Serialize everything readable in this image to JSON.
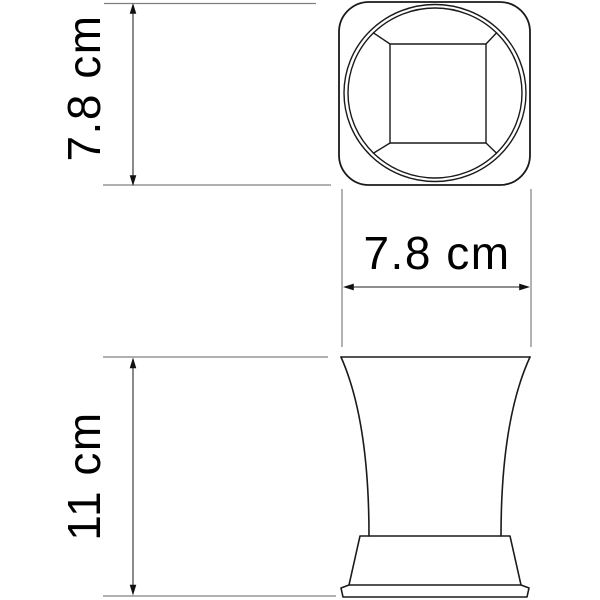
{
  "drawing": {
    "kind": "product dimension drawing",
    "labels": {
      "top_view_height": "7.8 cm",
      "top_view_width": "7.8 cm",
      "side_view_height": "11 cm"
    },
    "values": {
      "top_view_height_cm": 7.8,
      "top_view_width_cm": 7.8,
      "side_view_height_cm": 11
    },
    "colors": {
      "outline": "#1a1a1a",
      "extension_line": "#808080",
      "dimension_line": "#4a4a4a",
      "arrowhead": "#111111",
      "text": "#000000",
      "background": "#ffffff"
    }
  }
}
